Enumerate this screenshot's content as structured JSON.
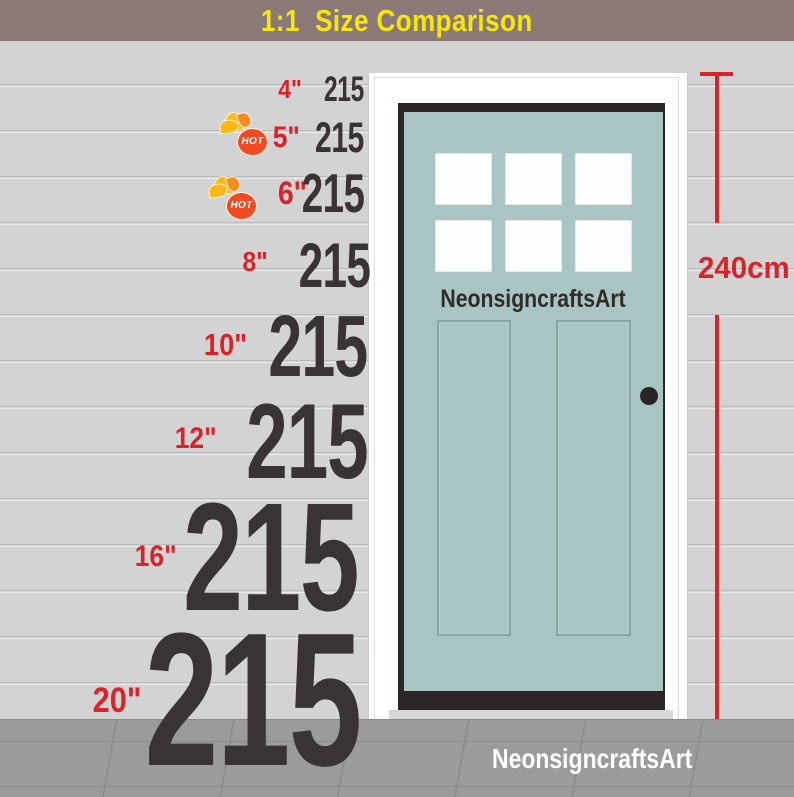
{
  "banner": {
    "title": "1:1  Size Comparison"
  },
  "sizes": [
    {
      "label": "4\"",
      "value": "215",
      "hot": false
    },
    {
      "label": "5\"",
      "value": "215",
      "hot": true
    },
    {
      "label": "6\"",
      "value": "215",
      "hot": true
    },
    {
      "label": "8\"",
      "value": "215",
      "hot": false
    },
    {
      "label": "10\"",
      "value": "215",
      "hot": false
    },
    {
      "label": "12\"",
      "value": "215",
      "hot": false
    },
    {
      "label": "16\"",
      "value": "215",
      "hot": false
    },
    {
      "label": "20\"",
      "value": "215",
      "hot": false
    }
  ],
  "hot_badge": {
    "label": "HOT"
  },
  "door": {
    "brand": "NeonsigncraftsArt",
    "window_panes": 6
  },
  "floor": {
    "brand": "NeonsigncraftsArt"
  },
  "dimension": {
    "height_label": "240cm"
  },
  "colors": {
    "banner_bg": "#8b7977",
    "banner_text": "#f6e70c",
    "wall": "#d3d3d4",
    "number": "#3a3335",
    "accent_red": "#d9232b",
    "door_teal": "#a8c5c3",
    "door_frame": "#ffffff",
    "floor": "#9b9b9b",
    "hot_badge": "#f04a23"
  }
}
